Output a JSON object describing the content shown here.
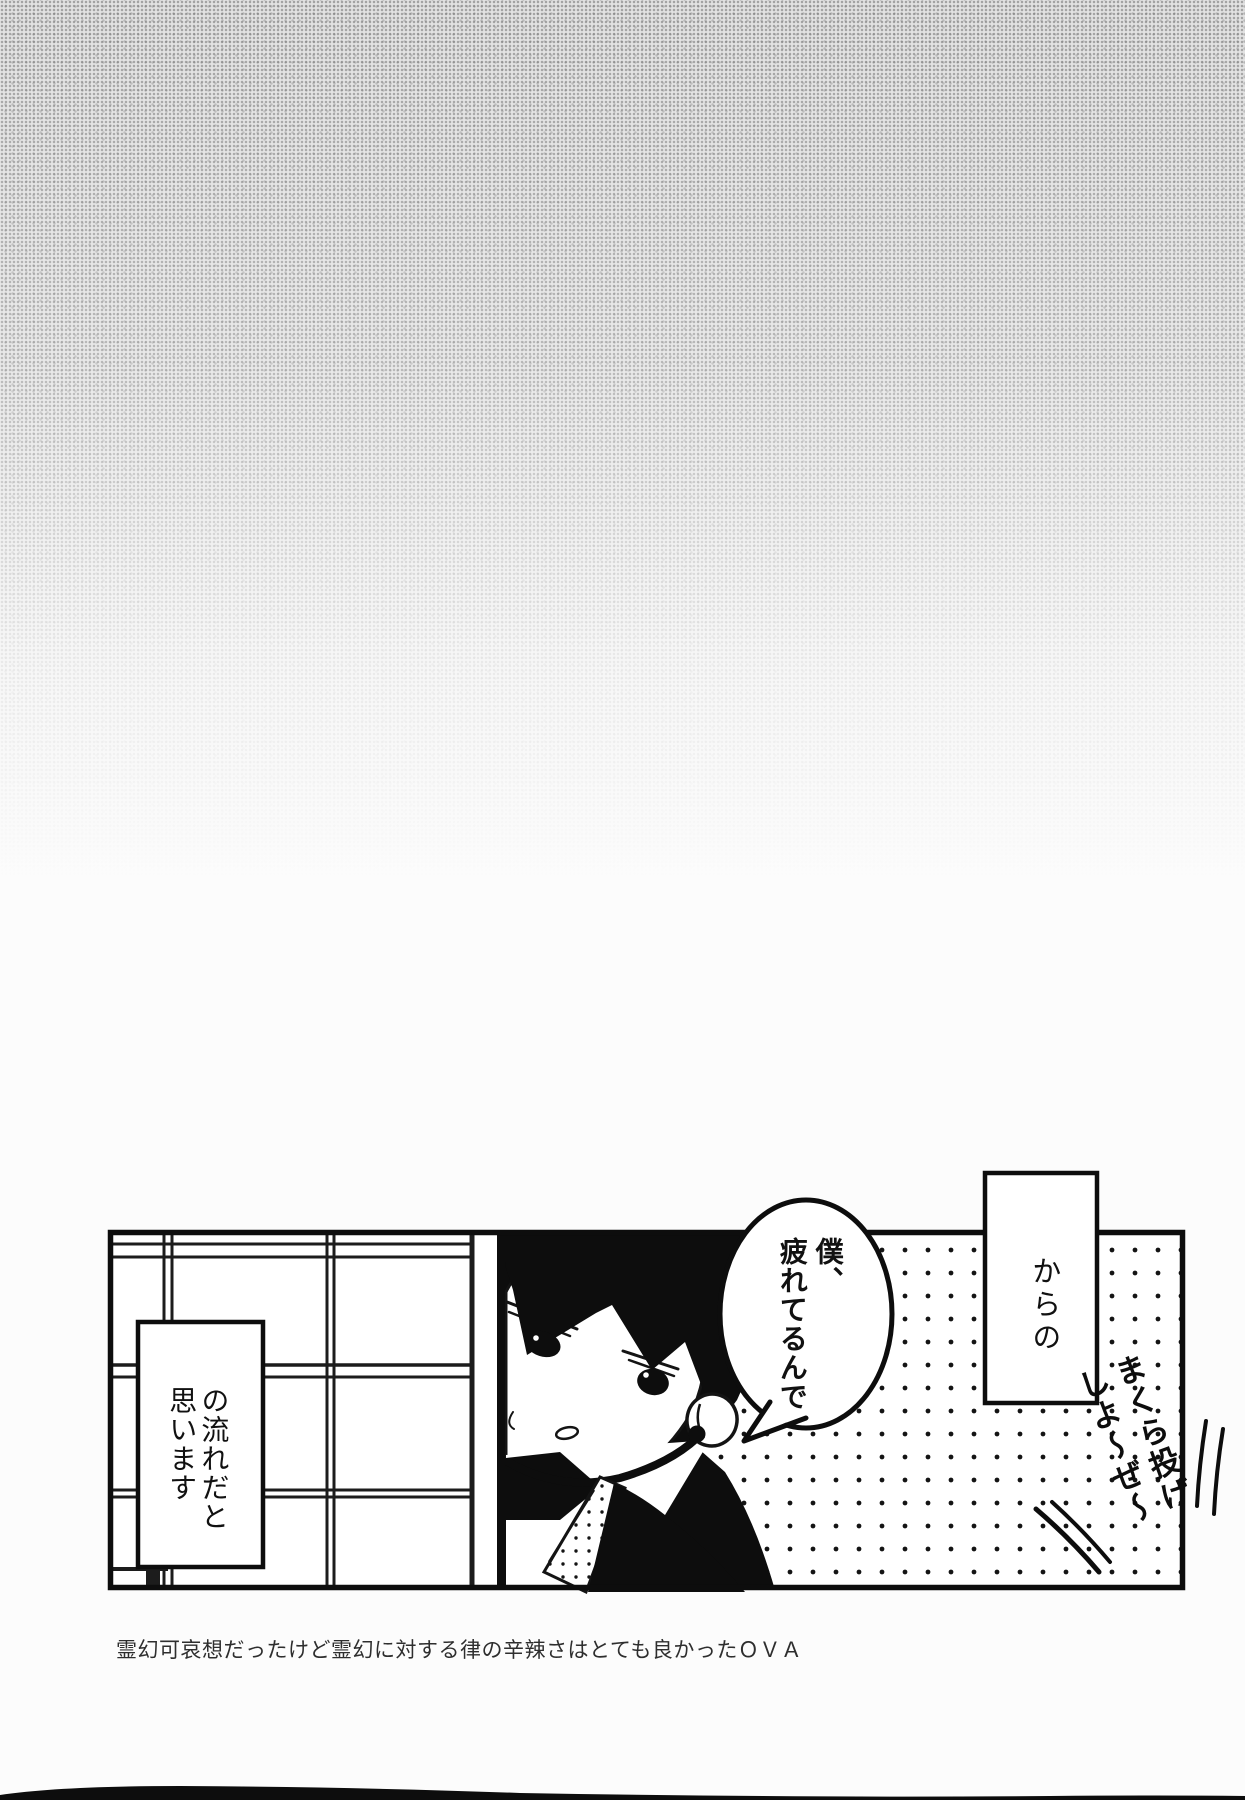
{
  "page": {
    "caption": "霊幻可哀想だったけど霊幻に対する律の辛辣さはとても良かったＯＶＡ"
  },
  "panel": {
    "speech_bubble": {
      "line1": "僕、",
      "line2": "疲れてるんで"
    },
    "narration_right": {
      "text": "からの"
    },
    "narration_left": {
      "line1": "の流れだと",
      "line2": "思います"
    },
    "handwritten": {
      "line1": "まくら投げ",
      "line2": "しよ～ぜ～"
    }
  },
  "colors": {
    "ink": "#0d0d0d",
    "paper": "#fcfcfc",
    "paper_texture": "#d8d8d8",
    "caption_ink": "#2e2e2e"
  }
}
